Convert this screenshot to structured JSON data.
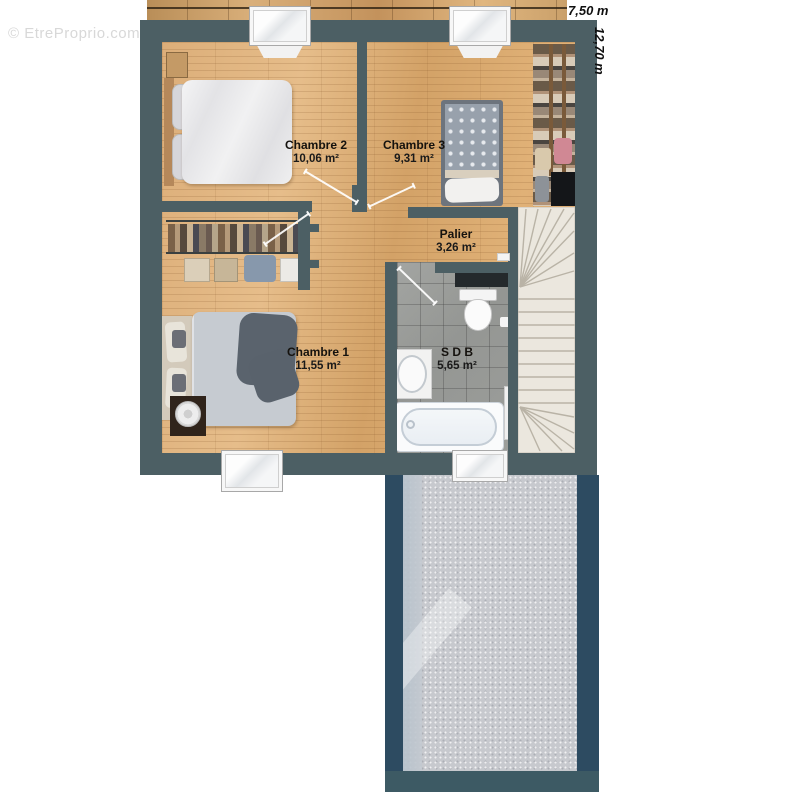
{
  "watermark": "© EtreProprio.com",
  "dimensions": {
    "width": "7,50 m",
    "height": "12,70 m"
  },
  "rooms": {
    "chambre2": {
      "name": "Chambre 2",
      "area": "10,06 m²"
    },
    "chambre3": {
      "name": "Chambre 3",
      "area": "9,31 m²"
    },
    "palier": {
      "name": "Palier",
      "area": "3,26 m²"
    },
    "chambre1": {
      "name": "Chambre 1",
      "area": "11,55 m²"
    },
    "sdb": {
      "name": "S D B",
      "area": "5,65 m²"
    }
  },
  "colors": {
    "wall": "#4c5f64",
    "terrace_wall": "#2d4b61",
    "wood_floor": "#d8a973",
    "bathroom_floor": "#969896",
    "stair": "#ebe7de",
    "terrace_floor": "#c7c9ce",
    "light_beam": "#ffeec3"
  }
}
